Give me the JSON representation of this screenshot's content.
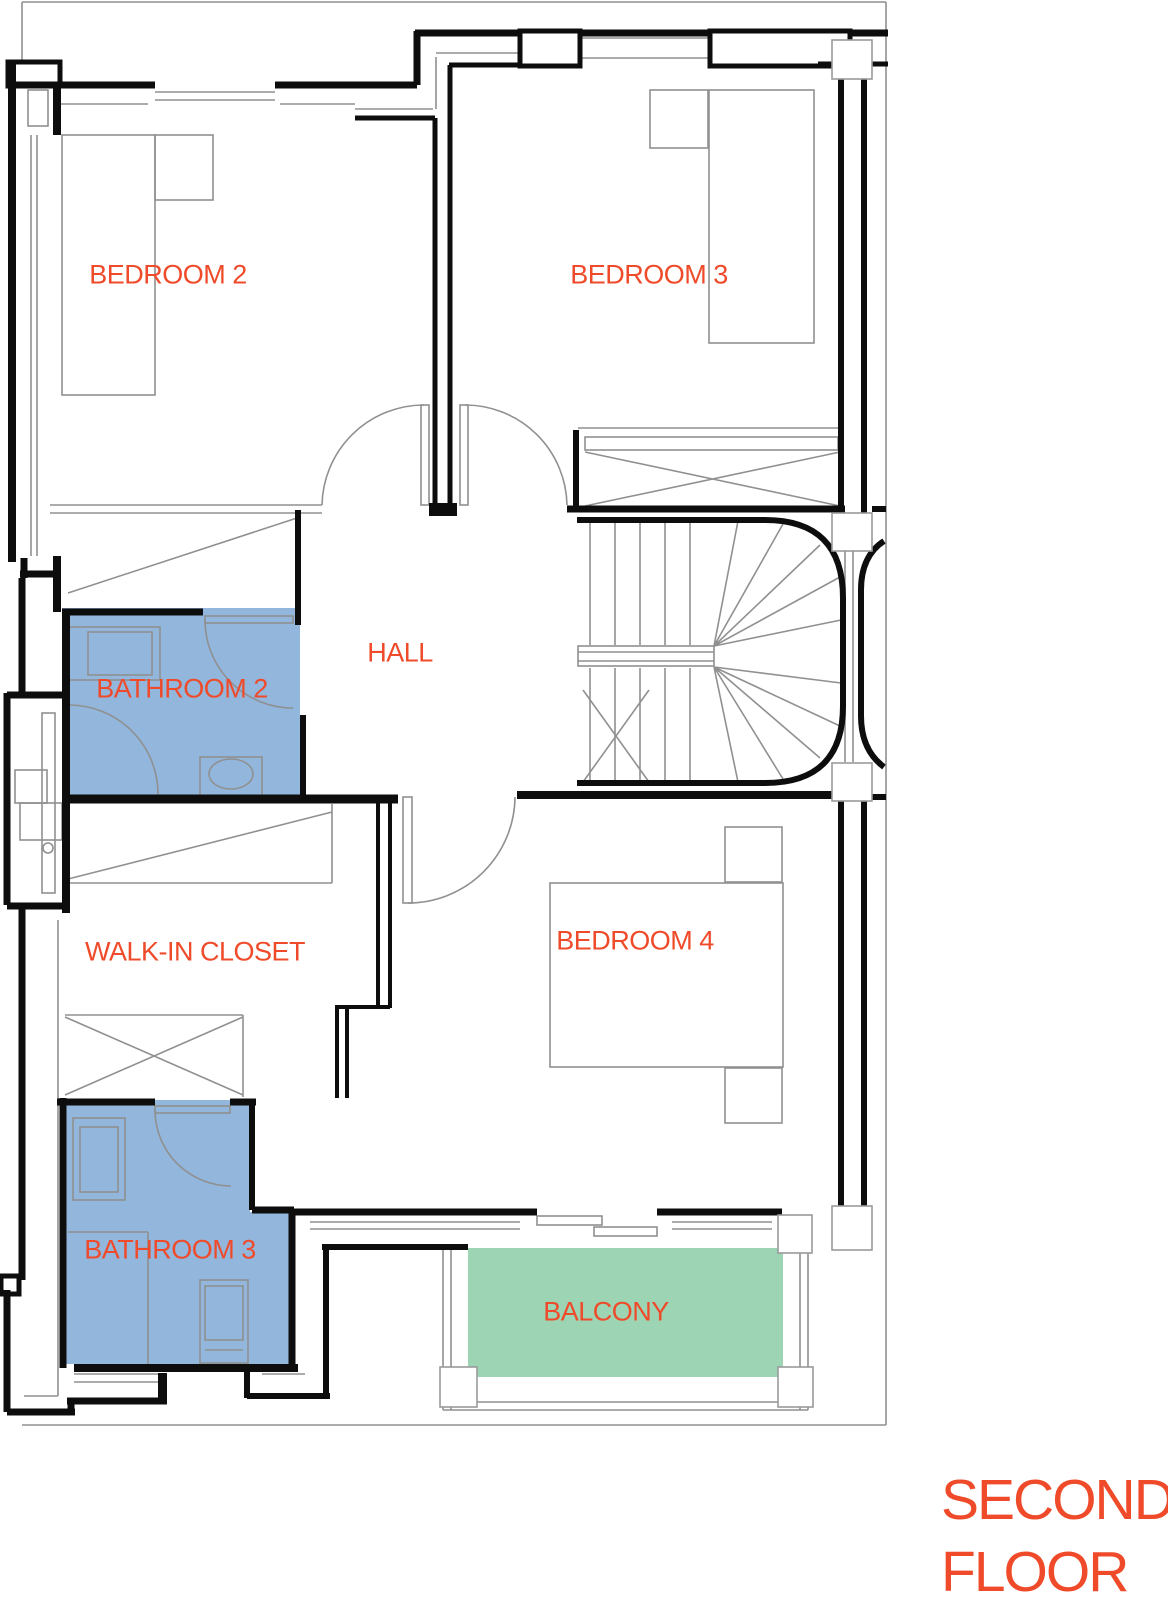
{
  "title": {
    "line1": "SECOND",
    "line2": "FLOOR",
    "full": "SECOND FLOOR"
  },
  "colors": {
    "label_text": "#ef4b2b",
    "bathroom_fill": "#92b6dc",
    "balcony_fill": "#9cd4b4",
    "wall": "#0d0d0d",
    "thin_line": "#909090",
    "background": "#ffffff"
  },
  "rooms": [
    {
      "id": "bedroom-2",
      "label": "BEDROOM 2"
    },
    {
      "id": "bedroom-3",
      "label": "BEDROOM 3"
    },
    {
      "id": "hall",
      "label": "HALL"
    },
    {
      "id": "bathroom-2",
      "label": "BATHROOM 2"
    },
    {
      "id": "walk-in-closet",
      "label": "WALK-IN CLOSET"
    },
    {
      "id": "bedroom-4",
      "label": "BEDROOM 4"
    },
    {
      "id": "bathroom-3",
      "label": "BATHROOM 3"
    },
    {
      "id": "balcony",
      "label": "BALCONY"
    }
  ]
}
